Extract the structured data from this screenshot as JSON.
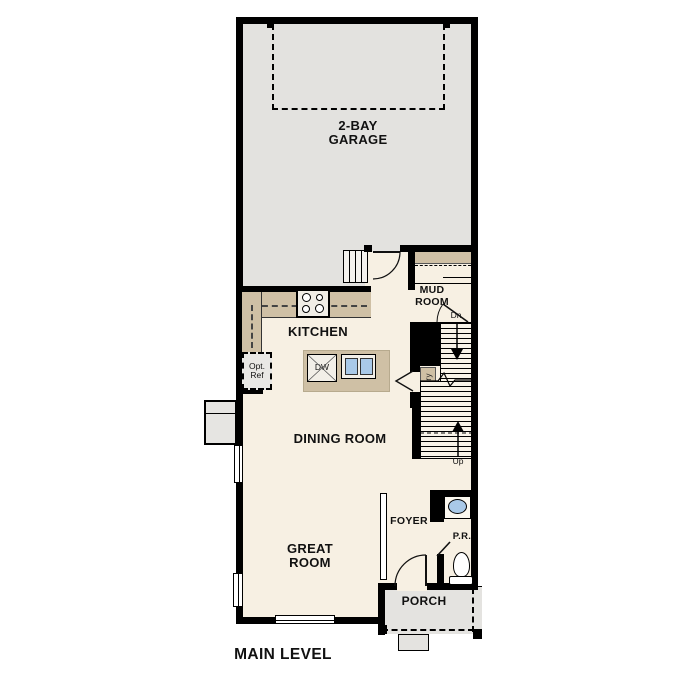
{
  "plan": {
    "title": "MAIN LEVEL",
    "rooms": {
      "garage": "2-BAY\nGARAGE",
      "kitchen": "KITCHEN",
      "mud_room": "MUD\nROOM",
      "dining_room": "DINING ROOM",
      "great_room": "GREAT\nROOM",
      "foyer": "FOYER",
      "powder_room": "P.R.",
      "porch": "PORCH",
      "pantry": "Pantry"
    },
    "annotations": {
      "stairs_down": "Dn",
      "stairs_up": "Up",
      "optional_refrigerator": "Opt.\nRef",
      "dishwasher": "DW"
    },
    "colors": {
      "wall": "#000000",
      "garage_fill": "#e3e2df",
      "floor_fill": "#f7f0e3",
      "counter_fill": "#cfc0a5",
      "porch_fill": "#e4e3e0",
      "fixture_blue": "#a9c9e8"
    }
  }
}
